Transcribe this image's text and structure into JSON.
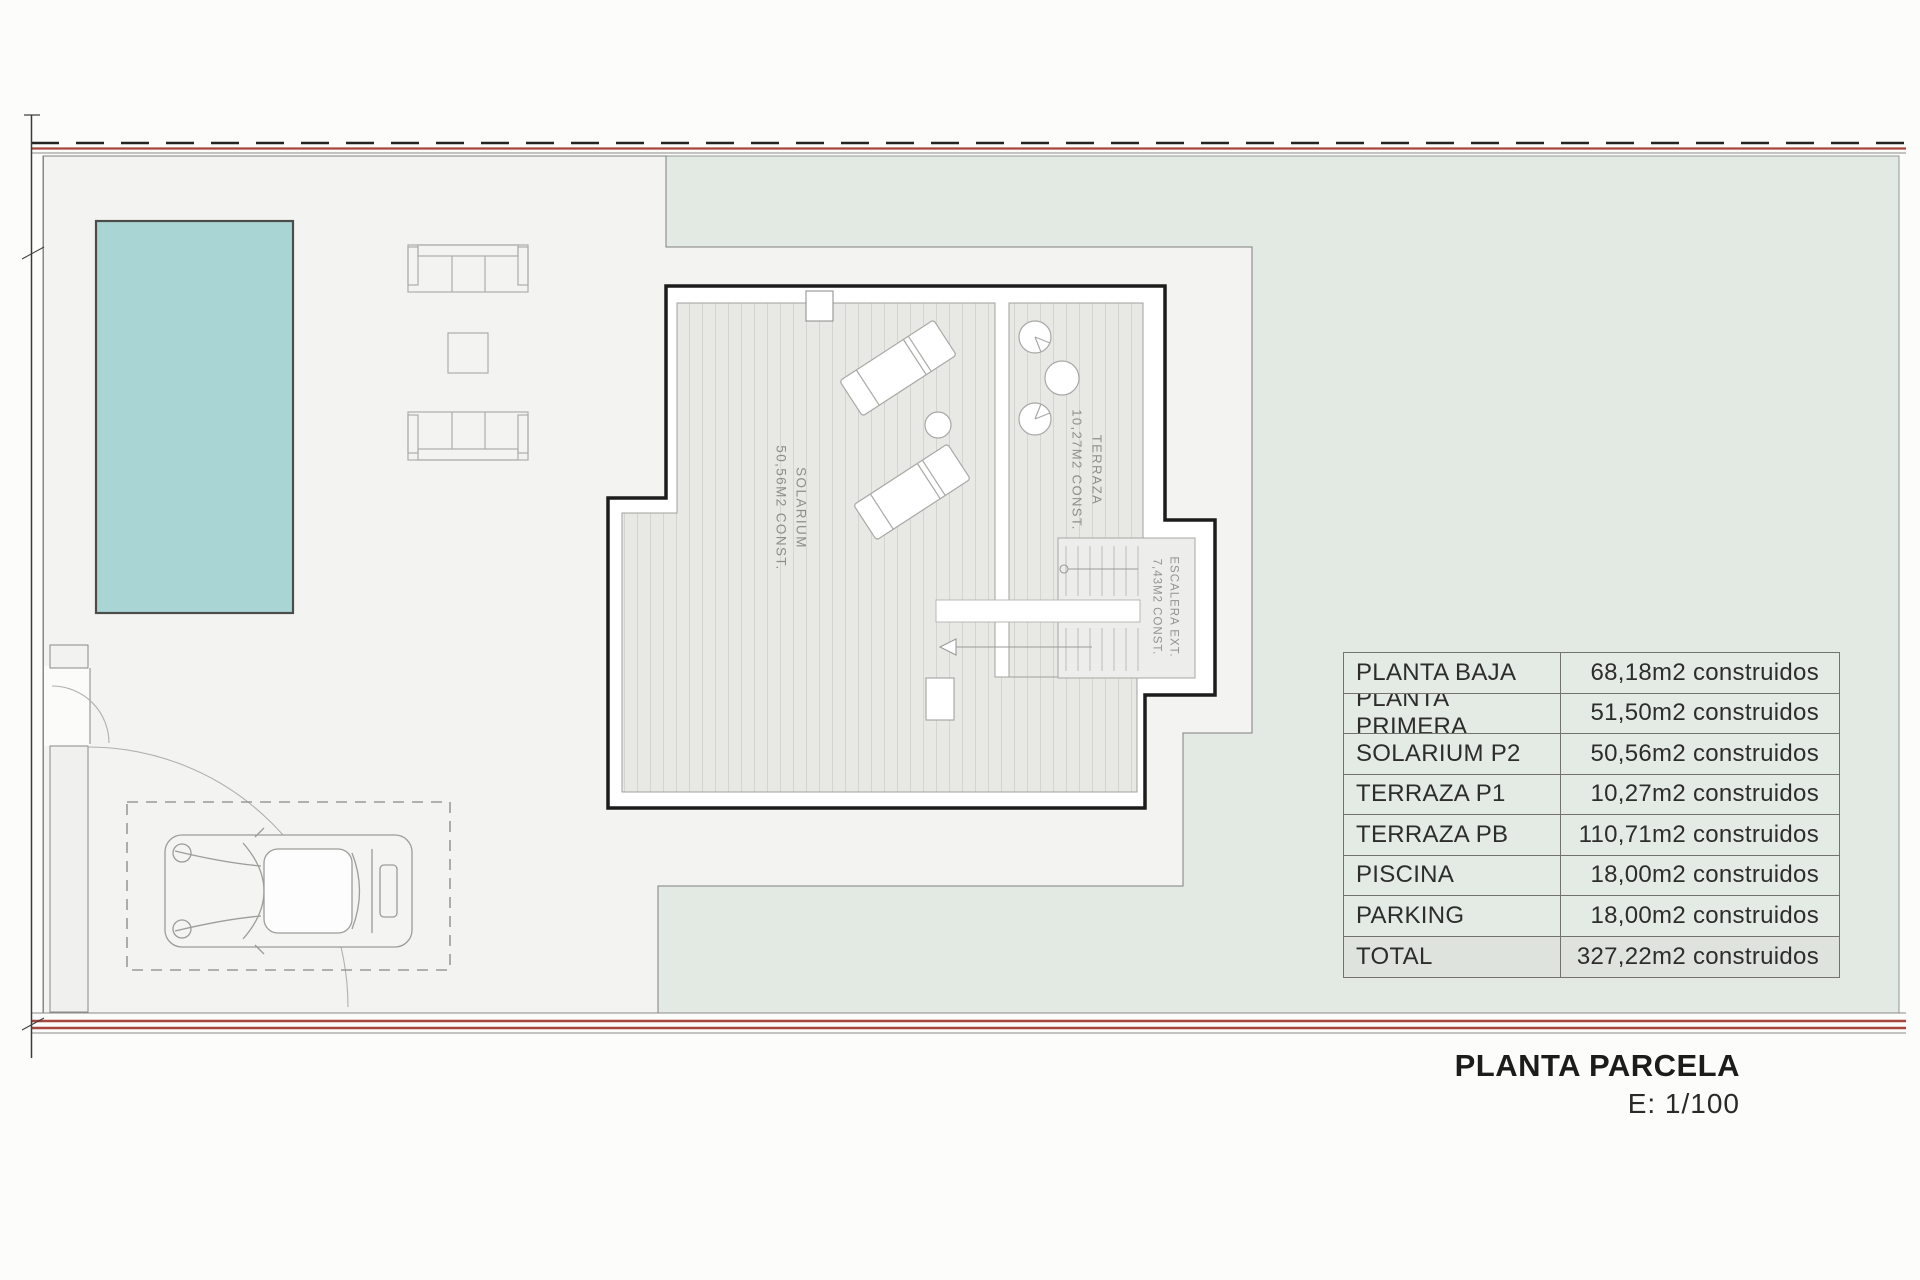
{
  "plan_labels": {
    "solarium": {
      "name": "SOLARIUM",
      "area": "50,56m2 const."
    },
    "terraza": {
      "name": "TERRAZA",
      "area": "10,27m2 const."
    },
    "escalera": {
      "name": "ESCALERA EXT.",
      "area": "7,43m2 const."
    }
  },
  "areas_table": {
    "rows": [
      {
        "label": "PLANTA BAJA",
        "value": "68,18m2 construidos"
      },
      {
        "label": "PLANTA PRIMERA",
        "value": "51,50m2 construidos"
      },
      {
        "label": "SOLARIUM P2",
        "value": "50,56m2 construidos"
      },
      {
        "label": "TERRAZA P1",
        "value": "10,27m2 construidos"
      },
      {
        "label": "TERRAZA PB",
        "value": "110,71m2 construidos"
      },
      {
        "label": "PISCINA",
        "value": "18,00m2 construidos"
      },
      {
        "label": "PARKING",
        "value": "18,00m2 construidos"
      },
      {
        "label": "TOTAL",
        "value": "327,22m2 construidos"
      }
    ]
  },
  "title_block": {
    "title": "PLANTA PARCELA",
    "scale": "E: 1/100"
  },
  "colors": {
    "pool": "#a9d6d5",
    "garden_green": "#e3eae4",
    "terrace_gray": "#f3f3f1",
    "boundary_red": "#a8453c",
    "building_outline": "#1c1c1c"
  }
}
